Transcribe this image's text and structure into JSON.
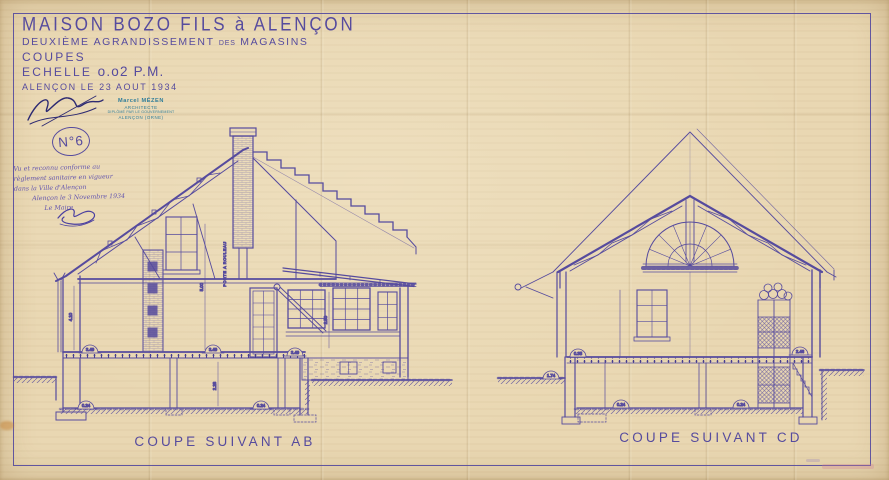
{
  "colors": {
    "ink": "#564b9e",
    "ink_dark": "#463d90",
    "paper": "#e9d7b2",
    "stamp_blue": "#2f7d9a",
    "signature_ink": "#2d2a72",
    "note_ink": "#6456ae",
    "faint_pink": "#d27d96"
  },
  "title_block": {
    "line1": "MAISON BOZO FILS à ALENÇON",
    "line2_a": "DEUXIÈME AGRANDISSEMENT",
    "line2_b": "DES",
    "line2_c": "MAGASINS",
    "line3": "COUPES",
    "scale_label": "ECHELLE",
    "scale_value": "o.o2 P.M.",
    "line5": "ALENÇON LE 23 AOUT 1934"
  },
  "architect_stamp": {
    "line1": "Marcel MÉZEN",
    "line2": "ARCHITECTE",
    "line3": "DIPLÔMÉ PAR LE GOUVERNEMENT",
    "line4": "ALENÇON (ORNE)"
  },
  "drawing_number": "N°6",
  "approval_note": {
    "line1": "Vu et reconnu conforme au",
    "line2": "règlement sanitaire en vigueur",
    "line3": "dans la Ville d'Alençon",
    "line4": "Alençon le 3 Novembre 1934",
    "line5": "Le Maire"
  },
  "section_ab": {
    "caption": "COUPE SUIVANT AB",
    "annotation": "PORTE A ROULEAU",
    "floor_dims": [
      "3.49",
      "3.49",
      "3.49"
    ],
    "base_dims": [
      "0.24",
      "0.24"
    ],
    "height_dims": [
      "4.10",
      "5.00",
      "2.28",
      "2.50"
    ]
  },
  "section_cd": {
    "caption": "COUPE SUIVANT CD",
    "floor_dims": [
      "0.35",
      "2.46"
    ],
    "ground_dim": "1.74",
    "base_dims": [
      "0.24",
      "0.24"
    ]
  }
}
